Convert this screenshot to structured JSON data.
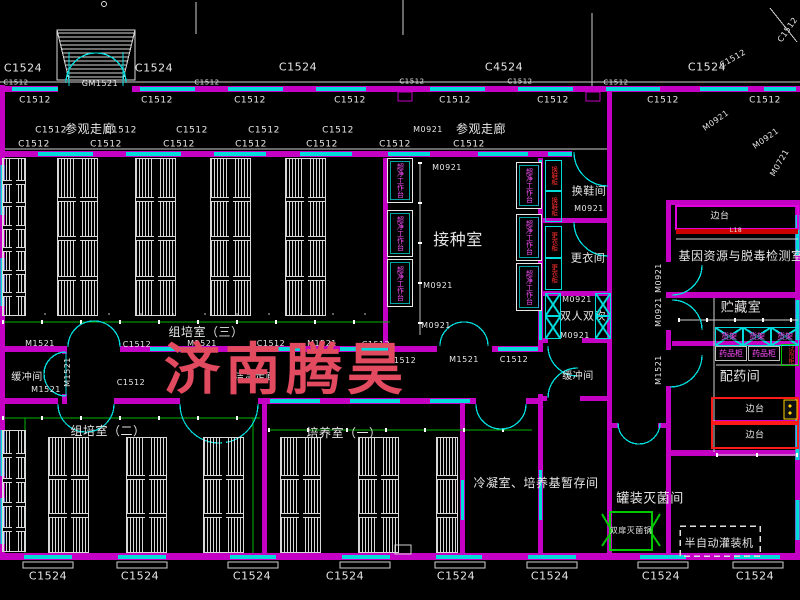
{
  "watermark": {
    "text": "济南腾昊",
    "color": "#e14a5f"
  },
  "colors": {
    "background": "#000000",
    "wall": "#c400c4",
    "window": "#00dcdc",
    "cad_text": "#e6e6e6",
    "dimension_green": "#00b400",
    "equipment_text_magenta": "#ff4dff",
    "equipment_text_red": "#ff3030",
    "bench_border_red": "#ff1a1a",
    "sterilizer_green": "#00c800",
    "sink_yellow": "#ffd400",
    "watermark_red": "#e14a5f"
  },
  "labels": [
    {
      "t": "C1524",
      "x": 23,
      "y": 68,
      "s": 11
    },
    {
      "t": "C1524",
      "x": 154,
      "y": 68,
      "s": 11
    },
    {
      "t": "C1524",
      "x": 298,
      "y": 67,
      "s": 11
    },
    {
      "t": "C4524",
      "x": 504,
      "y": 67,
      "s": 11
    },
    {
      "t": "C1524",
      "x": 707,
      "y": 67,
      "s": 11
    },
    {
      "t": "C1512",
      "x": 733,
      "y": 59,
      "s": 8,
      "r": -30
    },
    {
      "t": "C1512",
      "x": 788,
      "y": 30,
      "s": 8,
      "r": -55
    },
    {
      "t": "C1512",
      "x": 16,
      "y": 83,
      "s": 7
    },
    {
      "t": "C1512",
      "x": 207,
      "y": 83,
      "s": 7
    },
    {
      "t": "C1512",
      "x": 412,
      "y": 82,
      "s": 7
    },
    {
      "t": "C1512",
      "x": 520,
      "y": 82,
      "s": 7
    },
    {
      "t": "C1512",
      "x": 616,
      "y": 83,
      "s": 7
    },
    {
      "t": "GM1521",
      "x": 100,
      "y": 84,
      "s": 8
    },
    {
      "t": "C1512",
      "x": 35,
      "y": 101,
      "s": 9
    },
    {
      "t": "C1512",
      "x": 157,
      "y": 101,
      "s": 9
    },
    {
      "t": "C1512",
      "x": 250,
      "y": 101,
      "s": 9
    },
    {
      "t": "C1512",
      "x": 350,
      "y": 101,
      "s": 9
    },
    {
      "t": "C1512",
      "x": 455,
      "y": 101,
      "s": 9
    },
    {
      "t": "C1512",
      "x": 553,
      "y": 101,
      "s": 9
    },
    {
      "t": "C1512",
      "x": 663,
      "y": 101,
      "s": 9
    },
    {
      "t": "C1512",
      "x": 765,
      "y": 101,
      "s": 9
    },
    {
      "t": "参观走廊",
      "x": 90,
      "y": 129,
      "s": 12,
      "n": "room-label-visit-corridor-left"
    },
    {
      "t": "参观走廊",
      "x": 481,
      "y": 129,
      "s": 12,
      "n": "room-label-visit-corridor-right"
    },
    {
      "t": "C1512",
      "x": 51,
      "y": 131,
      "s": 9
    },
    {
      "t": "C1512",
      "x": 121,
      "y": 131,
      "s": 9
    },
    {
      "t": "C1512",
      "x": 192,
      "y": 131,
      "s": 9
    },
    {
      "t": "C1512",
      "x": 264,
      "y": 131,
      "s": 9
    },
    {
      "t": "C1512",
      "x": 338,
      "y": 131,
      "s": 9
    },
    {
      "t": "M0921",
      "x": 428,
      "y": 130,
      "s": 8
    },
    {
      "t": "C1512",
      "x": 34,
      "y": 145,
      "s": 9
    },
    {
      "t": "C1512",
      "x": 106,
      "y": 145,
      "s": 9
    },
    {
      "t": "C1512",
      "x": 179,
      "y": 145,
      "s": 9
    },
    {
      "t": "C1512",
      "x": 251,
      "y": 145,
      "s": 9
    },
    {
      "t": "C1512",
      "x": 322,
      "y": 145,
      "s": 9
    },
    {
      "t": "C1512",
      "x": 395,
      "y": 145,
      "s": 9
    },
    {
      "t": "C1512",
      "x": 469,
      "y": 145,
      "s": 9
    },
    {
      "t": "M0921",
      "x": 716,
      "y": 121,
      "s": 8,
      "r": -35
    },
    {
      "t": "M0921",
      "x": 766,
      "y": 139,
      "s": 8,
      "r": -35
    },
    {
      "t": "M0721",
      "x": 780,
      "y": 163,
      "s": 8,
      "r": -60
    },
    {
      "t": "M0921",
      "x": 447,
      "y": 168,
      "s": 8
    },
    {
      "t": "M0921",
      "x": 438,
      "y": 286,
      "s": 8
    },
    {
      "t": "M0921",
      "x": 436,
      "y": 326,
      "s": 8
    },
    {
      "t": "接种室",
      "x": 458,
      "y": 240,
      "s": 16,
      "n": "room-label-inoculation"
    },
    {
      "t": "换鞋间",
      "x": 589,
      "y": 191,
      "s": 11,
      "n": "room-label-shoe-change"
    },
    {
      "t": "M0921",
      "x": 589,
      "y": 209,
      "s": 8
    },
    {
      "t": "更衣间",
      "x": 588,
      "y": 258,
      "s": 11,
      "n": "room-label-dressing"
    },
    {
      "t": "M0921",
      "x": 577,
      "y": 300,
      "s": 8
    },
    {
      "t": "双人双吹",
      "x": 583,
      "y": 316,
      "s": 11,
      "n": "room-label-air-shower"
    },
    {
      "t": "M0921",
      "x": 575,
      "y": 336,
      "s": 8
    },
    {
      "t": "缓冲间",
      "x": 578,
      "y": 377,
      "s": 10,
      "n": "room-label-buffer-right"
    },
    {
      "t": "缓冲间",
      "x": 27,
      "y": 378,
      "s": 10,
      "n": "room-label-buffer-left"
    },
    {
      "t": "M1521",
      "x": 46,
      "y": 390,
      "s": 8
    },
    {
      "t": "M1521",
      "x": 68,
      "y": 372,
      "s": 8,
      "r": -90
    },
    {
      "t": "C1512",
      "x": 131,
      "y": 383,
      "s": 8
    },
    {
      "t": "M1521",
      "x": 40,
      "y": 344,
      "s": 8
    },
    {
      "t": "C1512",
      "x": 137,
      "y": 345,
      "s": 8
    },
    {
      "t": "M1521",
      "x": 202,
      "y": 344,
      "s": 8
    },
    {
      "t": "C1512",
      "x": 271,
      "y": 344,
      "s": 8
    },
    {
      "t": "M1521",
      "x": 322,
      "y": 344,
      "s": 8
    },
    {
      "t": "C1512",
      "x": 376,
      "y": 345,
      "s": 8
    },
    {
      "t": "C1512",
      "x": 402,
      "y": 361,
      "s": 8
    },
    {
      "t": "M1521",
      "x": 464,
      "y": 360,
      "s": 8
    },
    {
      "t": "C1512",
      "x": 514,
      "y": 360,
      "s": 8
    },
    {
      "t": "洁净走廊",
      "x": 255,
      "y": 378,
      "s": 10,
      "n": "room-label-clean-corridor"
    },
    {
      "t": "组培室（三）",
      "x": 206,
      "y": 332,
      "s": 12,
      "n": "room-label-tissue-culture-3"
    },
    {
      "t": "组培室（二）",
      "x": 108,
      "y": 431,
      "s": 12,
      "n": "room-label-tissue-culture-2"
    },
    {
      "t": "培养室（一）",
      "x": 344,
      "y": 433,
      "s": 12,
      "n": "room-label-cultivation-1"
    },
    {
      "t": "冷凝室、培养基暂存间",
      "x": 536,
      "y": 483,
      "s": 12,
      "n": "room-label-condensation-medium-storage"
    },
    {
      "t": "M0921",
      "x": 659,
      "y": 278,
      "s": 8,
      "r": -90
    },
    {
      "t": "M0921",
      "x": 659,
      "y": 312,
      "s": 8,
      "r": -90
    },
    {
      "t": "M1521",
      "x": 659,
      "y": 370,
      "s": 8,
      "r": -90
    },
    {
      "t": "边台",
      "x": 720,
      "y": 217,
      "s": 9
    },
    {
      "t": "L18",
      "x": 736,
      "y": 231,
      "s": 6
    },
    {
      "t": "基因资源与脱毒检测室",
      "x": 741,
      "y": 256,
      "s": 12,
      "n": "room-label-gene-resource-detection"
    },
    {
      "t": "贮藏室",
      "x": 741,
      "y": 308,
      "s": 13,
      "n": "room-label-storage"
    },
    {
      "t": "配药间",
      "x": 740,
      "y": 377,
      "s": 13,
      "n": "room-label-drug-prep"
    },
    {
      "t": "边台",
      "x": 755,
      "y": 410,
      "s": 9
    },
    {
      "t": "边台",
      "x": 755,
      "y": 436,
      "s": 9
    },
    {
      "t": "罐装灭菌间",
      "x": 650,
      "y": 499,
      "s": 13,
      "n": "room-label-canning-sterilization"
    },
    {
      "t": "双扉灭菌锅",
      "x": 631,
      "y": 531,
      "s": 8,
      "n": "equip-label-double-door-sterilizer"
    },
    {
      "t": "半自动灌装机",
      "x": 719,
      "y": 543,
      "s": 11,
      "n": "equip-label-semi-auto-filler"
    },
    {
      "t": "C1524",
      "x": 48,
      "y": 576,
      "s": 11
    },
    {
      "t": "C1524",
      "x": 140,
      "y": 576,
      "s": 11
    },
    {
      "t": "C1524",
      "x": 252,
      "y": 576,
      "s": 11
    },
    {
      "t": "C1524",
      "x": 345,
      "y": 576,
      "s": 11
    },
    {
      "t": "C1524",
      "x": 456,
      "y": 576,
      "s": 11
    },
    {
      "t": "C1524",
      "x": 550,
      "y": 576,
      "s": 11
    },
    {
      "t": "C1524",
      "x": 661,
      "y": 576,
      "s": 11
    },
    {
      "t": "C1524",
      "x": 755,
      "y": 576,
      "s": 11
    }
  ],
  "racks": [
    {
      "x": 2,
      "y": 158,
      "w": 24,
      "h": 158,
      "cells": 7,
      "cols": 2
    },
    {
      "x": 57,
      "y": 158,
      "w": 41,
      "h": 158,
      "cells": 4,
      "cols": 2
    },
    {
      "x": 135,
      "y": 158,
      "w": 41,
      "h": 158,
      "cells": 4,
      "cols": 2
    },
    {
      "x": 210,
      "y": 158,
      "w": 41,
      "h": 158,
      "cells": 4,
      "cols": 2
    },
    {
      "x": 285,
      "y": 158,
      "w": 41,
      "h": 158,
      "cells": 4,
      "cols": 2
    },
    {
      "x": 2,
      "y": 430,
      "w": 24,
      "h": 122,
      "cells": 5,
      "cols": 2
    },
    {
      "x": 48,
      "y": 437,
      "w": 41,
      "h": 116,
      "cells": 3,
      "cols": 2
    },
    {
      "x": 126,
      "y": 437,
      "w": 41,
      "h": 116,
      "cells": 3,
      "cols": 2
    },
    {
      "x": 203,
      "y": 437,
      "w": 41,
      "h": 116,
      "cells": 3,
      "cols": 2
    },
    {
      "x": 280,
      "y": 437,
      "w": 41,
      "h": 116,
      "cells": 3,
      "cols": 2
    },
    {
      "x": 358,
      "y": 437,
      "w": 41,
      "h": 116,
      "cells": 3,
      "cols": 2
    },
    {
      "x": 436,
      "y": 437,
      "w": 22,
      "h": 116,
      "cells": 3,
      "cols": 1
    }
  ],
  "equipment": {
    "clean_benches": {
      "label": "超净工作台",
      "boxes": [
        [
          387,
          158,
          26,
          45
        ],
        [
          387,
          210,
          26,
          47
        ],
        [
          387,
          259,
          26,
          48
        ],
        [
          516,
          162,
          26,
          47
        ],
        [
          516,
          214,
          26,
          47
        ],
        [
          516,
          263,
          26,
          48
        ]
      ]
    },
    "shoe_cabinets": {
      "label": "换鞋柜",
      "boxes": [
        [
          545,
          160,
          17,
          31
        ],
        [
          545,
          191,
          17,
          31
        ]
      ]
    },
    "lockers": {
      "label": "更衣柜",
      "boxes": [
        [
          545,
          226,
          17,
          32
        ],
        [
          545,
          258,
          17,
          32
        ]
      ]
    },
    "air_shower_cells": {
      "boxes": [
        [
          545,
          293,
          16,
          23
        ],
        [
          545,
          316,
          16,
          23
        ],
        [
          595,
          293,
          16,
          23
        ],
        [
          595,
          316,
          16,
          23
        ]
      ]
    },
    "storage_racks": {
      "label": "货架",
      "boxes": [
        [
          715,
          327,
          28,
          19
        ],
        [
          743,
          327,
          28,
          19
        ],
        [
          771,
          327,
          28,
          19
        ]
      ]
    },
    "medicine_cabinets": {
      "label": "药品柜",
      "boxes": [
        [
          715,
          346,
          32,
          15
        ],
        [
          748,
          346,
          32,
          15
        ]
      ]
    },
    "reagent_cabinet": {
      "label": "试剂柜",
      "box": [
        781,
        344,
        18,
        22
      ]
    }
  }
}
